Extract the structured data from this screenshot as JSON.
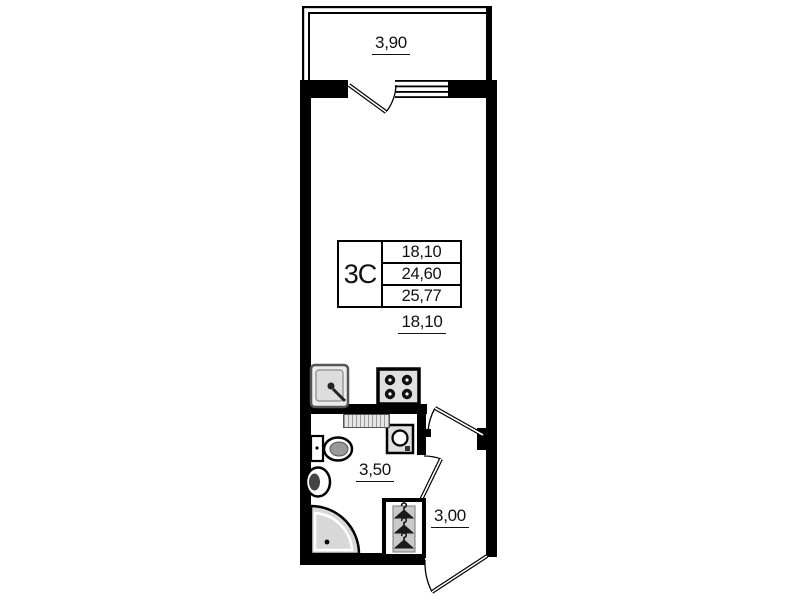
{
  "unit_card": {
    "type": "3C",
    "areas": [
      "18,10",
      "24,60",
      "25,77"
    ]
  },
  "labels": {
    "balcony_area": "3,90",
    "living_area": "18,10",
    "bathroom_area": "3,50",
    "hallway_area": "3,00"
  },
  "fixtures": [
    "kitchen-sink",
    "stove-4-burner",
    "washing-machine",
    "toilet",
    "wash-basin",
    "corner-shower",
    "wardrobe-hangers",
    "vent-shaft"
  ],
  "doors": [
    "balcony-door",
    "hall-door",
    "bathroom-door",
    "entry-door"
  ],
  "colors": {
    "wall": "#000000",
    "text": "#111111",
    "fixture_fill": "#e0e0e0",
    "shower_fill": "#d8d8d8",
    "hatch": "#9a9a9a"
  }
}
